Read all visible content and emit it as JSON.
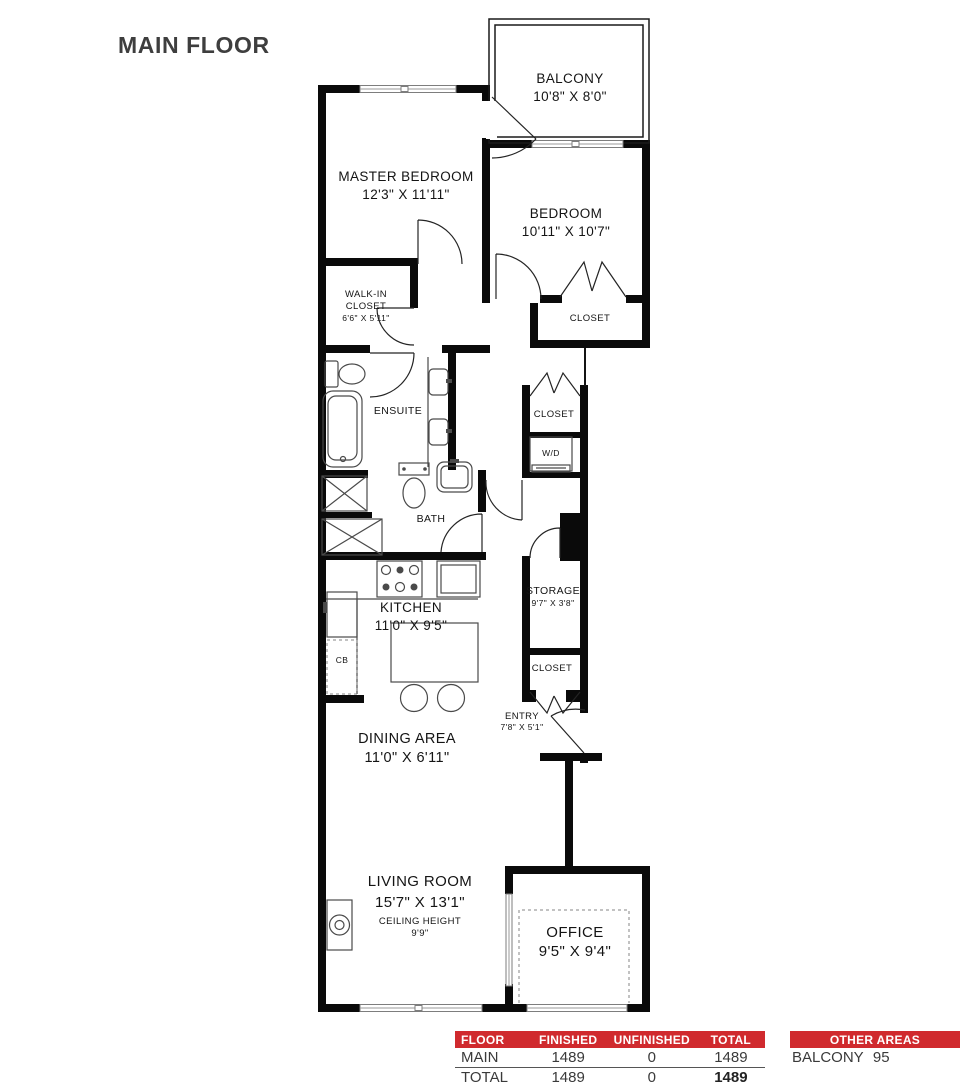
{
  "title": "MAIN FLOOR",
  "colors": {
    "accent_red": "#d02a2e",
    "title_gray": "#3e3e3e",
    "wall_black": "#0a0a0a"
  },
  "plan": {
    "rooms": {
      "balcony": {
        "name": "BALCONY",
        "dims": "10'8\" X 8'0\""
      },
      "master_bedroom": {
        "name": "MASTER BEDROOM",
        "dims": "12'3\" X 11'11\""
      },
      "bedroom": {
        "name": "BEDROOM",
        "dims": "10'11\" X 10'7\""
      },
      "bedroom_closet": {
        "name": "CLOSET"
      },
      "walk_in_closet": {
        "line1": "WALK-IN",
        "line2": "CLOSET",
        "dims": "6'6\" X 5'11\""
      },
      "ensuite": {
        "name": "ENSUITE"
      },
      "bath": {
        "name": "BATH"
      },
      "hall_closet": {
        "name": "CLOSET"
      },
      "laundry": {
        "name": "W/D"
      },
      "storage": {
        "name": "STORAGE",
        "dims": "9'7\" X 3'8\""
      },
      "entry_closet": {
        "name": "CLOSET"
      },
      "entry": {
        "name": "ENTRY",
        "dims": "7'8\" X 5'1\""
      },
      "kitchen": {
        "name": "KITCHEN",
        "dims": "11'0\" X 9'5\""
      },
      "cabinet": {
        "name": "CB"
      },
      "dining_area": {
        "name": "DINING AREA",
        "dims": "11'0\" X 6'11\""
      },
      "living_room": {
        "name": "LIVING ROOM",
        "dims": "15'7\" X 13'1\"",
        "ceiling_label": "CEILING HEIGHT",
        "ceiling_value": "9'9\""
      },
      "office": {
        "name": "OFFICE",
        "dims": "9'5\" X 9'4\""
      }
    }
  },
  "floor_table": {
    "headers": {
      "floor": "FLOOR",
      "finished": "FINISHED",
      "unfinished": "UNFINISHED",
      "total": "TOTAL"
    },
    "rows": [
      {
        "floor": "MAIN",
        "finished": "1489",
        "unfinished": "0",
        "total": "1489"
      },
      {
        "floor": "TOTAL",
        "finished": "1489",
        "unfinished": "0",
        "total": "1489"
      }
    ]
  },
  "other_areas_table": {
    "header": "OTHER AREAS",
    "rows": [
      {
        "name": "BALCONY",
        "value": "95"
      }
    ]
  }
}
